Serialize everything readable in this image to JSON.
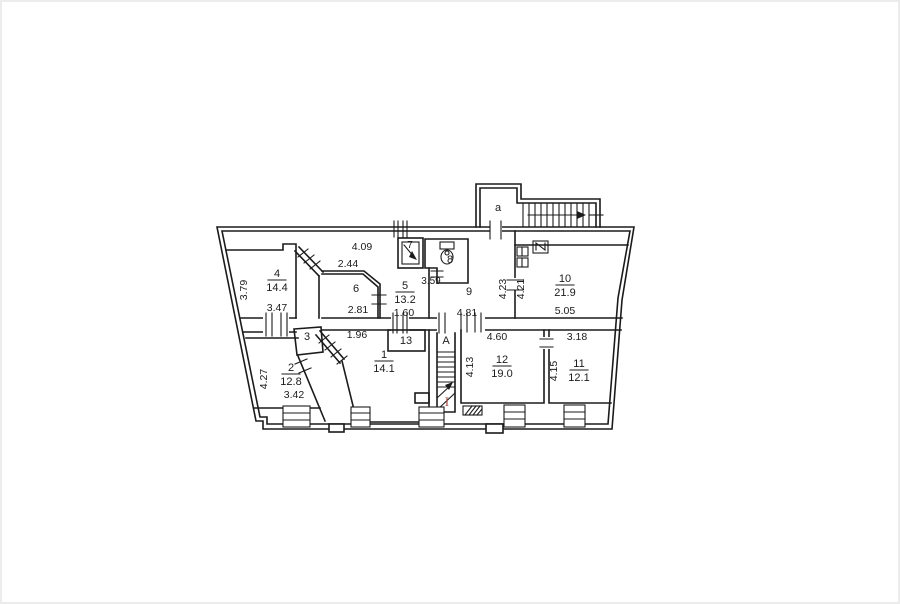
{
  "colors": {
    "ink": "#1b1b1b",
    "floor_marker_red": "#a5473d",
    "background": "#ffffff"
  },
  "plan": {
    "type": "apartment-floor-plan",
    "entrance_vestibule_label": "a",
    "staircase_label": "A",
    "floor_number_marker": "I",
    "rooms": {
      "r1": {
        "number": "1",
        "area": "14.1"
      },
      "r2": {
        "number": "2",
        "area": "12.8"
      },
      "r3": {
        "number": "3"
      },
      "r4": {
        "number": "4",
        "area": "14.4"
      },
      "r5": {
        "number": "5",
        "area": "13.2"
      },
      "r6": {
        "number": "6"
      },
      "r7": {
        "number": "7"
      },
      "r8": {
        "number": "8"
      },
      "r9": {
        "number": "9"
      },
      "r10": {
        "number": "10",
        "area": "21.9"
      },
      "r11": {
        "number": "11",
        "area": "12.1"
      },
      "r12": {
        "number": "12",
        "area": "19.0"
      },
      "r13": {
        "number": "13"
      }
    },
    "dims": {
      "room1_width": "1.96",
      "room2_height": "4.27",
      "room2_width": "3.42",
      "room4_height": "3.79",
      "room4_width": "3.47",
      "room5_width": "1.60",
      "room6_top_width": "4.09",
      "room6_partition": "2.44",
      "room6_width": "2.81",
      "room8_width": "3.59",
      "room9_width": "4.81",
      "room9_height": "4.23",
      "room10_height": "4.21",
      "room10_width": "5.05",
      "room11_top_width": "3.18",
      "room11_height": "4.15",
      "room12_top_width": "4.60",
      "room12_height": "4.13"
    }
  }
}
